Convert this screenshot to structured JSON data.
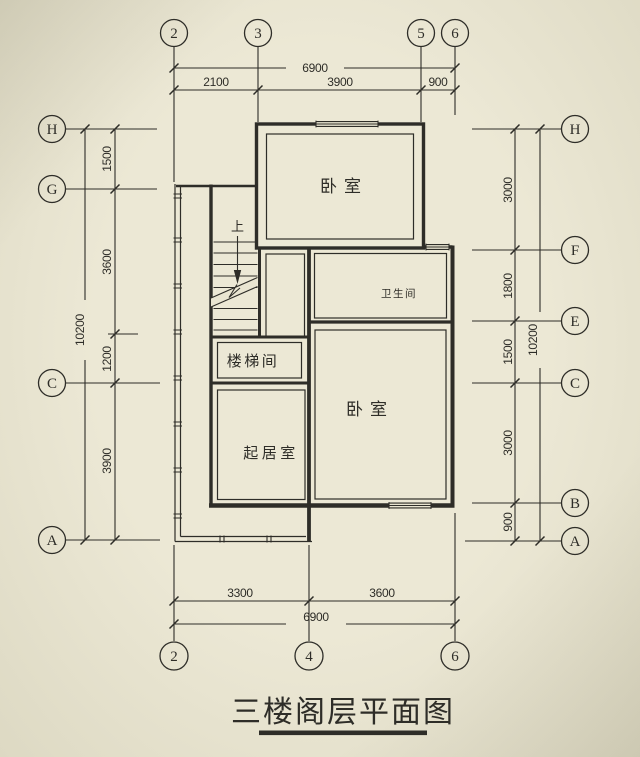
{
  "title": {
    "text": "三楼阁层平面图"
  },
  "rooms": {
    "bedroom_top": "卧室",
    "bathroom": "卫生间",
    "bedroom_right": "卧室",
    "stairwell": "楼梯间",
    "living_room": "起居室",
    "stairs_up": "上"
  },
  "axes": {
    "top": [
      "2",
      "3",
      "5",
      "6"
    ],
    "bottom": [
      "2",
      "4",
      "6"
    ],
    "left": [
      "H",
      "G",
      "C",
      "A"
    ],
    "right": [
      "H",
      "F",
      "E",
      "C",
      "B",
      "A"
    ]
  },
  "dims": {
    "top": {
      "overall": "6900",
      "segments": [
        "2100",
        "3900",
        "900"
      ]
    },
    "bottom": {
      "overall": "6900",
      "segments": [
        "3300",
        "3600"
      ]
    },
    "left": {
      "overall": "10200",
      "segments": [
        "1500",
        "3600",
        "1200",
        "3900"
      ]
    },
    "right": {
      "overall": "10200",
      "segments": [
        "3000",
        "1800",
        "1500",
        "3000",
        "900"
      ]
    }
  },
  "colors": {
    "background": "#e9e5d1",
    "ink": "#2e2d28"
  }
}
